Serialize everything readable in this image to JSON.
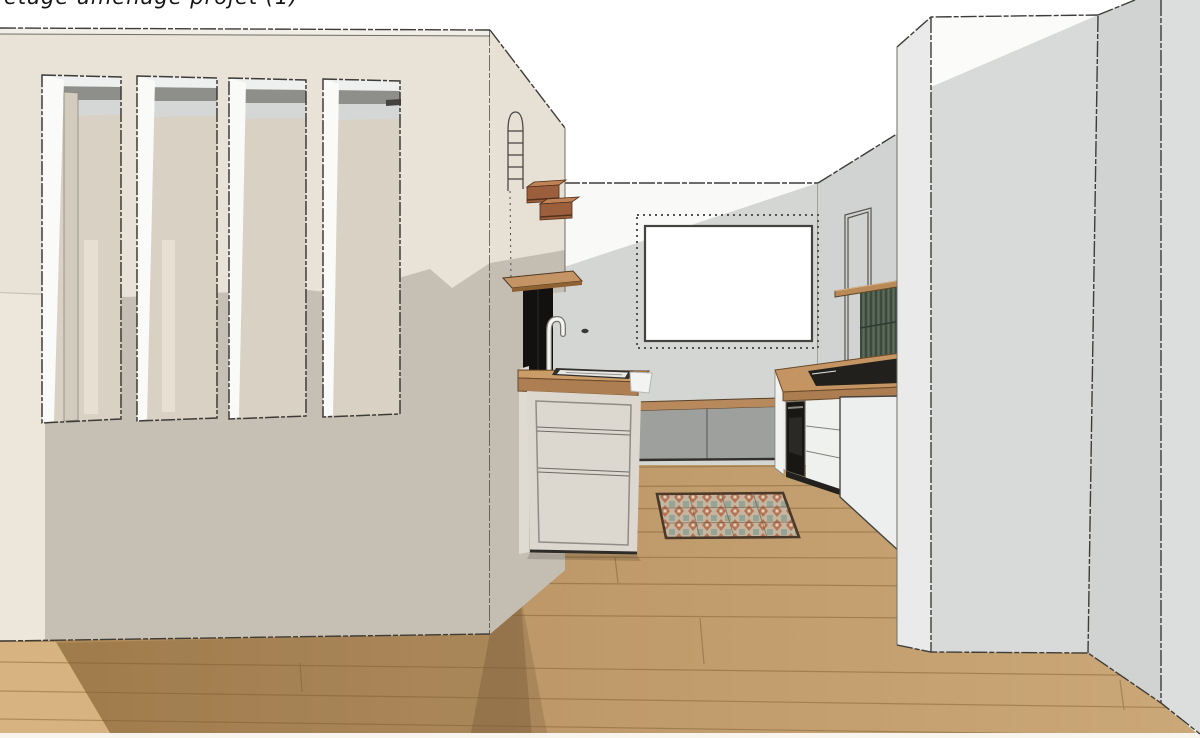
{
  "annotation": {
    "text": "étage aménagé  projet (1)"
  },
  "scene": {
    "kind": "3d-interior-render-viewport",
    "room": "kitchen and living area, sketch-style white render",
    "elements": [
      "left partition wall with four tall vertical window openings",
      "narrow arched opening seen edge-on in wall return",
      "two stacked wooden box shelves on wall return",
      "wooden wall shelf over tall black cabinet",
      "kitchen island with wood countertop, sink, white gooseneck faucet, three drawers",
      "low bench with wood top and two gray door panels under wall screen",
      "white wall screen / board with dotted niche outline on back wall",
      "patterned terracotta-and-sage rug on wood floor",
      "right kitchen run: wood counter, black cooktop, built-in black oven, white drawer fronts, white end panel",
      "dark green fluted backsplash with wood shelf above",
      "thin door outline drawn on right wall",
      "tall white column volume on the right",
      "light oak plank flooring with cast shadows"
    ]
  },
  "colors": {
    "background": "#ffffff",
    "wall_cream": "#e9e2d6",
    "wall_cream_shadow": "#c6bfb4",
    "wall_left_strip": "#ece6db",
    "window_interior": "#d9d1c4",
    "window_header_dark": "#8e8e8b",
    "window_header_light": "#d5d7d6",
    "window_jamb_white": "#fafaf9",
    "back_wall_gray": "#d4d6d4",
    "back_wall_white_wedge": "#f9f9f7",
    "right_wall_gray": "#d1d3d2",
    "column_left_face": "#e9eae9",
    "column_front_face": "#d8dad9",
    "column_return_face": "#d1d3d2",
    "column_right_face": "#dcdedd",
    "floor_wood_dark": "#b08a58",
    "floor_wood_light": "#c9a676",
    "floor_lit_triangle": "#d6b381",
    "counter_wood": "#c99c68",
    "counter_wood_edge": "#ac7e51",
    "island_front": "#dcd7cf",
    "bench_gray": "#9da09c",
    "bench_wood": "#b8895c",
    "cabinet_white": "#eff1ef",
    "oven_black": "#191714",
    "tall_cabinet_black": "#131110",
    "backsplash_green": "#51604f",
    "backsplash_green_dark": "#36453a",
    "shelf_wood": "#b98a58",
    "box_shelf_wood": "#9c5f3e",
    "rug_base": "#c6b5a0",
    "rug_terracotta": "#b57352",
    "rug_sage": "#96a593",
    "rug_border": "#4a3829",
    "outline_ink": "#3e3c38"
  }
}
